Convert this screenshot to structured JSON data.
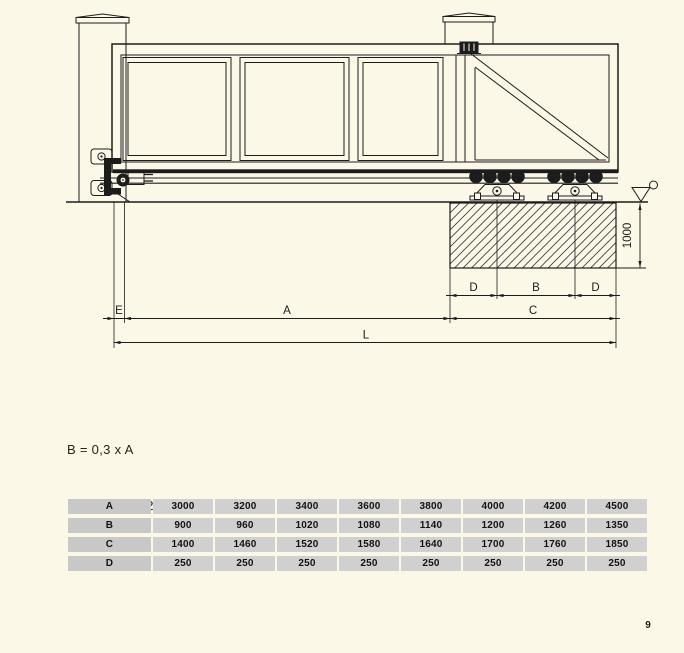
{
  "page": {
    "page_number": "9"
  },
  "colors": {
    "background": "#FBF8E8",
    "line": "#1c1c1c",
    "table_cell": "#d0d0d0",
    "table_label_cell": "#c8c8c8"
  },
  "drawing": {
    "dimension_labels": {
      "E": "E",
      "A": "A",
      "L": "L",
      "C": "C",
      "B": "B",
      "D_left": "D",
      "D_right": "D",
      "depth": "1000"
    }
  },
  "formulas": {
    "line1": "B = 0,3 x A",
    "line2": "L = A + B + ( 2 x D) + E"
  },
  "table": {
    "rows": [
      {
        "label": "A",
        "values": [
          "3000",
          "3200",
          "3400",
          "3600",
          "3800",
          "4000",
          "4200",
          "4500"
        ]
      },
      {
        "label": "B",
        "values": [
          "900",
          "960",
          "1020",
          "1080",
          "1140",
          "1200",
          "1260",
          "1350"
        ]
      },
      {
        "label": "C",
        "values": [
          "1400",
          "1460",
          "1520",
          "1580",
          "1640",
          "1700",
          "1760",
          "1850"
        ]
      },
      {
        "label": "D",
        "values": [
          "250",
          "250",
          "250",
          "250",
          "250",
          "250",
          "250",
          "250"
        ]
      }
    ]
  }
}
